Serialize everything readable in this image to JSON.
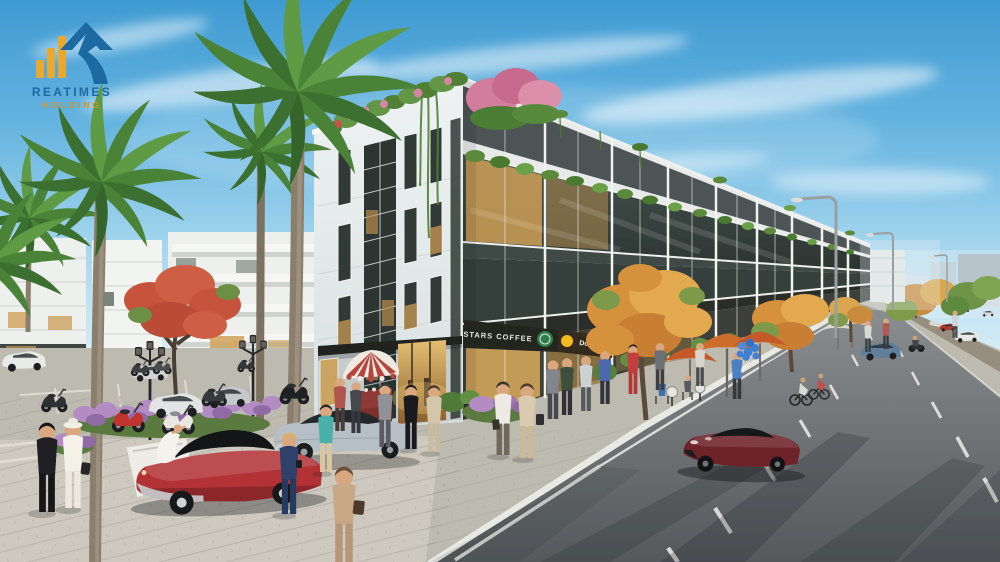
{
  "image": {
    "width": 1000,
    "height": 562,
    "type": "3d-architectural-render",
    "description": "Street-level render of a modern shophouse block with rooftop gardens, palm trees, cafe umbrellas, pedestrians, a red classic convertible, parked scooters and a dark-red sports car on the road."
  },
  "branding": {
    "title": "REATIMES",
    "subtitle": "HOLDING"
  },
  "signs": {
    "coffee_label": "STARS COFFEE",
    "burger_label": "Donal"
  },
  "palette": {
    "logo_blue": "#1d6aa3",
    "logo_gold": "#d99417",
    "logo_bars": "#eaa92c",
    "sign_bg": "#23261f",
    "sign_green": "#2e7d4c",
    "sign_yellow": "#f2bc1e",
    "awning_red": "#b5453e",
    "awning_white": "#efe9e0",
    "classic_car_red": "#b23236",
    "sports_car_red": "#6e2329",
    "sedan_silver": "#b6bfc6",
    "balloon_blue": "#3f7fd4",
    "sky_top": "#3f9ad2",
    "sky_horizon": "#e8f4f8",
    "tree_orange": "#d6913d",
    "flower_pink": "#d884a0",
    "flower_purple": "#b48cc4",
    "road_gray": "#6f7376",
    "sidewalk": "#c6c2b7",
    "facade_white": "#f1f3f2",
    "greenery": "#5f8a3e"
  }
}
